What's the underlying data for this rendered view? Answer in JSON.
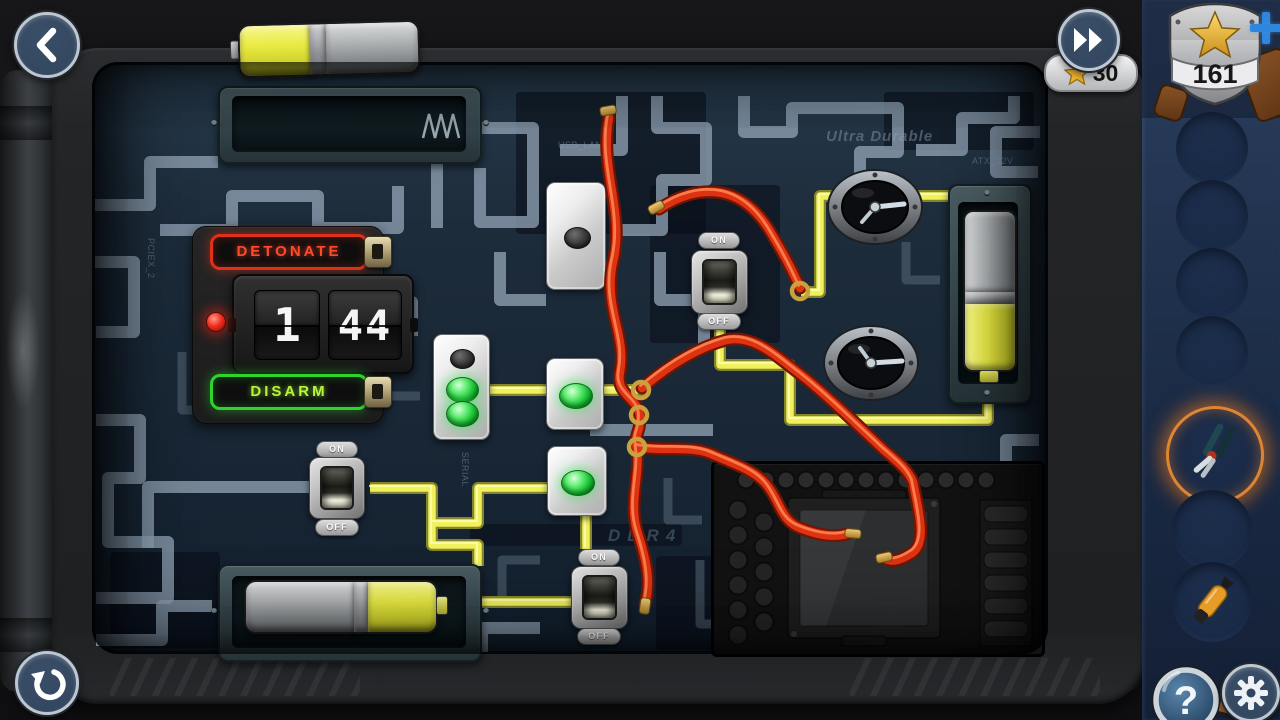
{
  "hud": {
    "stars": {
      "count": "30"
    },
    "badge": {
      "score": "161",
      "add_label": "+"
    },
    "hint_label": "?"
  },
  "timer": {
    "detonate": "DETONATE",
    "disarm": "DISARM",
    "min": "1",
    "sec": "44"
  },
  "switch_labels": {
    "on": "ON",
    "off": "OFF"
  },
  "board_labels": {
    "usb": "USB_LAN",
    "brand": "Ultra Durable",
    "atx": "ATX_12V",
    "serial": "SERIAL",
    "ddr": "DDR4",
    "pcie": "PCIEX_2"
  },
  "inventory": {
    "selected_item": "pliers",
    "items": [
      "pliers",
      "sealant-tool"
    ]
  },
  "icons": {
    "back": "chevron-left",
    "skip": "fast-forward",
    "restart": "restart-arrow",
    "hint": "question-magnifier",
    "settings": "gear",
    "star": "star",
    "plus": "plus",
    "badge": "police-badge-star"
  },
  "colors": {
    "wire_yellow": "#eff05c",
    "wire_red": "#dd3312",
    "led_green": "#22c93c",
    "detonate_red": "#ff4a2a",
    "disarm_green": "#2ed32e",
    "accent_blue": "#2f86df",
    "star_gold": "#f0b52e",
    "board_navy": "#1d2c3b"
  }
}
